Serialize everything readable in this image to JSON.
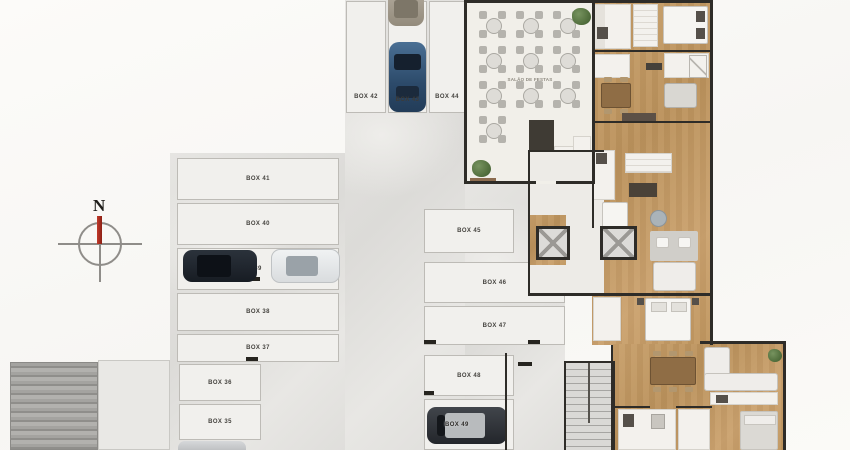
{
  "plan": {
    "compass": {
      "north": "N"
    },
    "party_hall": {
      "label": "SALÃO DE FESTAS"
    },
    "parking": {
      "boxes": {
        "b35": "BOX 35",
        "b36": "BOX 36",
        "b37": "BOX 37",
        "b38": "BOX 38",
        "b39": "39",
        "b40": "BOX 40",
        "b41": "BOX 41",
        "b42": "BOX 42",
        "b43": "BOX 43",
        "b44": "BOX 44",
        "b45": "BOX 45",
        "b46": "BOX 46",
        "b47": "BOX 47",
        "b48": "BOX 48",
        "b49": "BOX 49"
      }
    },
    "colors": {
      "wall": "#2e2c28",
      "wood_floor": "#c49a66",
      "garage_floor": "#e2e1de",
      "compass_needle": "#b03226",
      "stall_fill": "#f1f0ed"
    }
  }
}
